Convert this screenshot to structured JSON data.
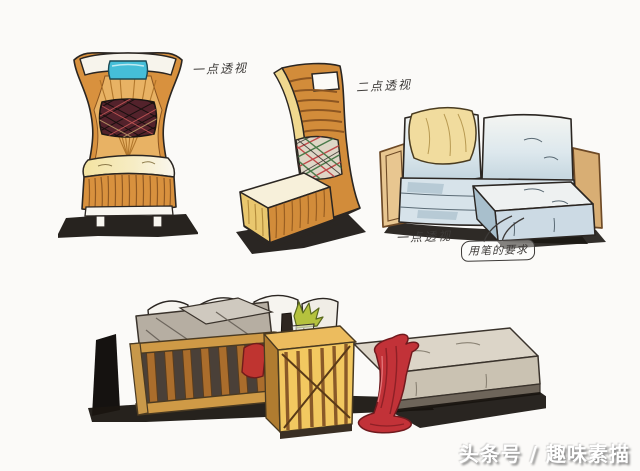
{
  "artwork": {
    "description_visible_text_only": true,
    "annotations": {
      "chair_front_label": "一点透视",
      "chair_angle_label": "二点透视",
      "sofa_label": "一点透视",
      "boxed_note": "用笔的要求"
    },
    "watermark": "头条号 / 趣味素描",
    "palette": {
      "paper": "#fbfaf8",
      "ink_outline": "#2b2622",
      "chair_orange": "#d8913e",
      "chair_orange_deep": "#8a5420",
      "chair_inner_amber": "#e8b264",
      "seat_cream": "#f3e3a1",
      "headrest_cyan": "#45bed8",
      "plaid_dark": "#53222b",
      "plaid_red": "#c04a4a",
      "plaid_green": "#4a7a4a",
      "sofa_blue": "#c6d6e0",
      "sofa_blue_light": "#eef1f1",
      "sofa_blue_shade": "#9db6c4",
      "pillow_yellow": "#f1dc9e",
      "wood_tan": "#cf9a46",
      "wood_dark": "#7a5524",
      "table_glow": "#f2c860",
      "throw_red": "#c23238",
      "ottoman_greige": "#dcd5c8",
      "shadow_black": "#17120e",
      "annotation_ink": "#3d3a38",
      "watermark_white": "#ffffff"
    }
  }
}
